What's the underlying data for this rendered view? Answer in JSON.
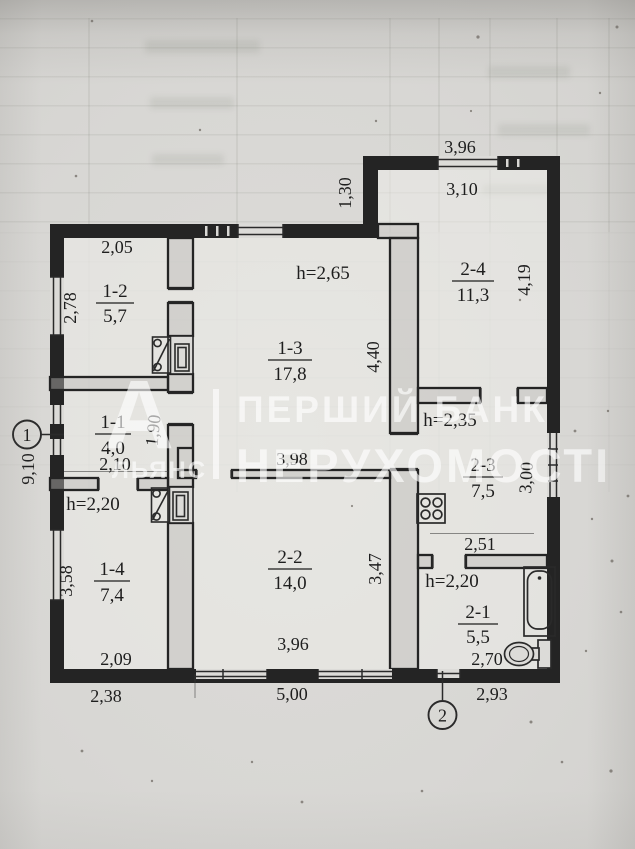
{
  "document": {
    "kind": "BTI floor plan scan"
  },
  "watermark": {
    "logo_letter": "А",
    "logo_caption": "ЛЬЯНС",
    "title_line1": "ПЕРШИЙ БАНК",
    "title_line2": "НЕРУХОМОСТІ",
    "color": "#ffffff"
  },
  "markers": {
    "m1": "1",
    "m2": "2"
  },
  "rooms": {
    "r11": {
      "id": "1-1",
      "area": "4,0"
    },
    "r12": {
      "id": "1-2",
      "area": "5,7"
    },
    "r13": {
      "id": "1-3",
      "area": "17,8",
      "height": "h=2,65"
    },
    "r14": {
      "id": "1-4",
      "area": "7,4",
      "height": "h=2,20"
    },
    "r21": {
      "id": "2-1",
      "area": "5,5",
      "height": "h=2,20"
    },
    "r22": {
      "id": "2-2",
      "area": "14,0"
    },
    "r23": {
      "id": "2-3",
      "area": "7,5",
      "height": "h=2,35"
    },
    "r24": {
      "id": "2-4",
      "area": "11,3"
    }
  },
  "dimensions": {
    "annex_top_outer": "3,96",
    "annex_top_inner": "3,10",
    "annex_left": "1,30",
    "annex_right": "4,19",
    "r12_top": "2,05",
    "r12_left": "2,78",
    "r13_right": "4,40",
    "r13_bottom": "3,98",
    "r11_right": "1,90",
    "r11_bottom": "2,10",
    "left_outer": "9,10",
    "r14_left": "3,58",
    "r14_bottom": "2,09",
    "bottom_left_outer": "2,38",
    "r22_right": "3,47",
    "r22_bottom": "3,96",
    "bottom_mid_outer": "5,00",
    "r23_right": "3,00",
    "r23_bottom": "2,51",
    "r21_bottom": "2,70",
    "bottom_right_outer": "2,93"
  },
  "fixtures": [
    "bathtub",
    "toilet",
    "gas-stove",
    "heating-stove-1",
    "heating-stove-2"
  ],
  "colors": {
    "paper": "#d8d7d4",
    "ink": "#242424",
    "watermark": "rgba(255,255,255,0.62)"
  }
}
